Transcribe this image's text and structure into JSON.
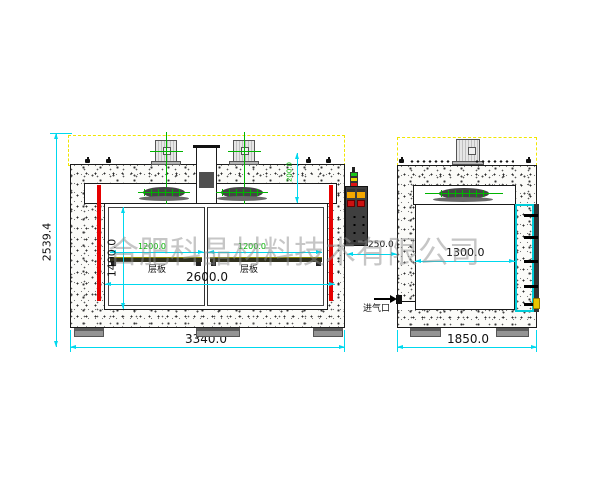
{
  "watermark": "合肥科晶材料技术有限公司",
  "front_view": {
    "overall_height": "2539.4",
    "overall_width": "3340.0",
    "chamber_width": "2600.0",
    "chamber_height": "1400.0",
    "shelf_width_left": "1200.0",
    "shelf_width_right": "1200.0",
    "top_plenum": "200.0",
    "shelf_label": "层板",
    "panel_offset": "250.0"
  },
  "side_view": {
    "overall_width": "1850.0",
    "chamber_depth": "1300.0",
    "air_inlet_label": "进气口"
  },
  "colors": {
    "dimension_cyan": "#00d8ee",
    "heater_red": "#e60000",
    "dim_green": "#00b400",
    "boundary_yellow": "#f0e600"
  }
}
